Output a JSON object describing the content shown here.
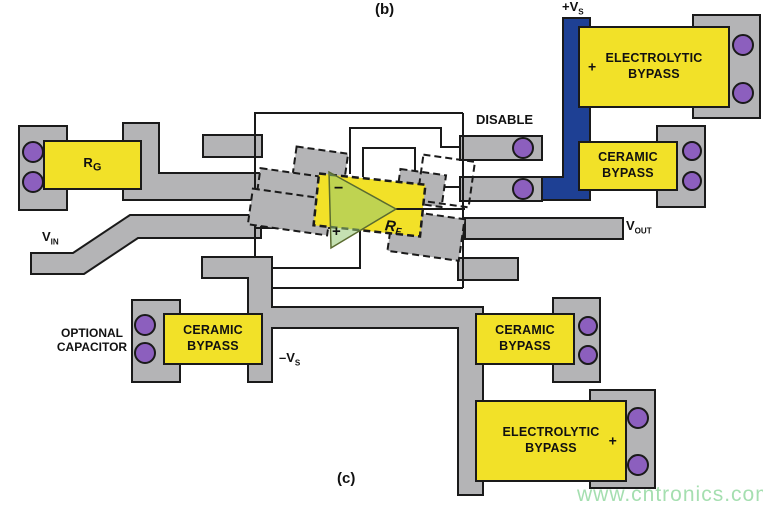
{
  "figure": {
    "label_b": "(b)",
    "label_c": "(c)"
  },
  "watermark": "www.cntronics.com",
  "power": {
    "pos": {
      "main": "+V",
      "sub": "S"
    },
    "neg": {
      "main": "–V",
      "sub": "S"
    }
  },
  "signals": {
    "disable": "DISABLE",
    "vin": {
      "main": "V",
      "sub": "IN"
    },
    "vout": {
      "main": "V",
      "sub": "OUT"
    }
  },
  "components": {
    "rg": {
      "main": "R",
      "sub": "G"
    },
    "rf": {
      "main": "R",
      "sub": "F"
    },
    "opamp": {
      "minus": "−",
      "plus": "+"
    },
    "electrolytic_top": {
      "line1": "ELECTROLYTIC",
      "line2": "BYPASS",
      "polarity": "+"
    },
    "ceramic_right": {
      "line1": "CERAMIC",
      "line2": "BYPASS"
    },
    "ceramic_bottom_left": {
      "line1": "CERAMIC",
      "line2": "BYPASS"
    },
    "ceramic_bottom_right": {
      "line1": "CERAMIC",
      "line2": "BYPASS"
    },
    "electrolytic_bottom": {
      "line1": "ELECTROLYTIC",
      "line2": "BYPASS",
      "polarity": "+"
    },
    "optional_capacitor": {
      "line1": "OPTIONAL",
      "line2": "CAPACITOR"
    }
  },
  "colors": {
    "trace_gray": "#b4b4b6",
    "component_yellow": "#f2e128",
    "via_purple": "#8c5fbe",
    "power_blue": "#1e4094",
    "outline": "#1a1a1a",
    "watermark_green": "#a5dfb0",
    "opamp_fill": "rgba(150,200,115,0.55)"
  }
}
